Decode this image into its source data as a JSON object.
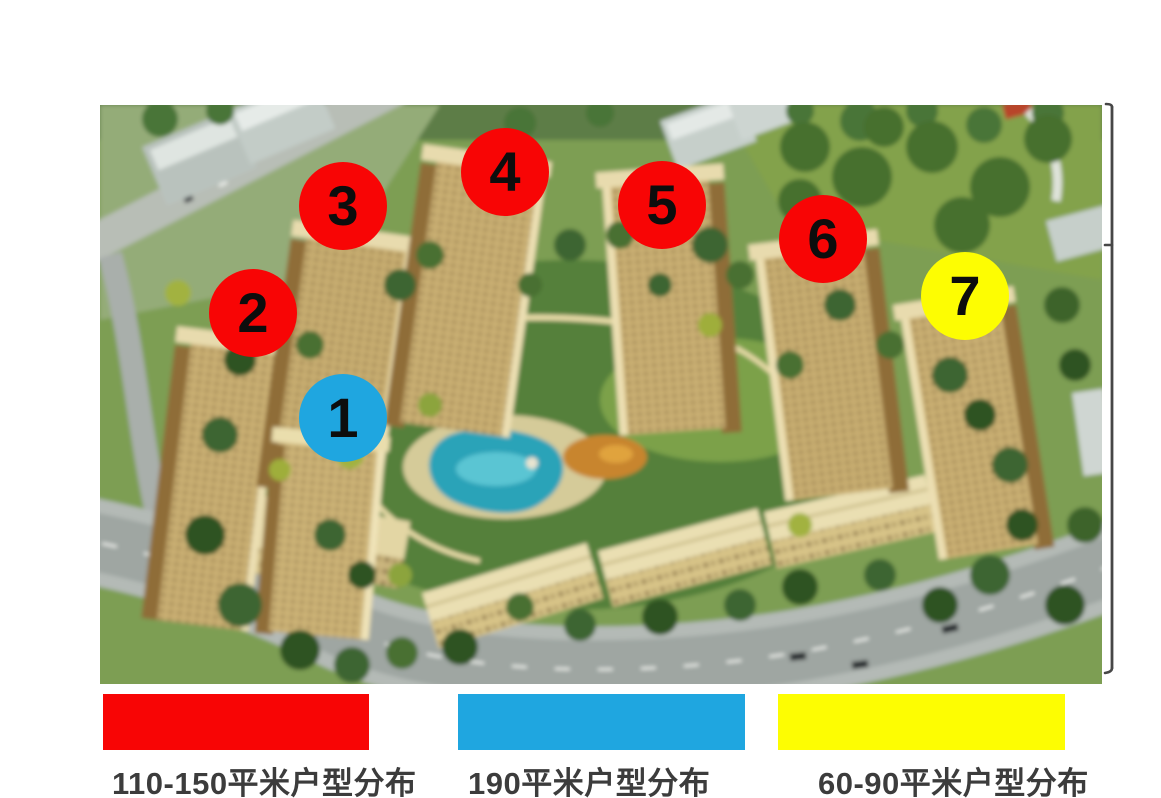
{
  "colors": {
    "red": "#f80505",
    "blue": "#1fa6e0",
    "yellow": "#fdfd02"
  },
  "site_plan": {
    "markers": [
      {
        "number": "1",
        "color": "blue",
        "x": 243,
        "y": 313
      },
      {
        "number": "2",
        "color": "red",
        "x": 153,
        "y": 208
      },
      {
        "number": "3",
        "color": "red",
        "x": 243,
        "y": 101
      },
      {
        "number": "4",
        "color": "red",
        "x": 405,
        "y": 67
      },
      {
        "number": "5",
        "color": "red",
        "x": 562,
        "y": 100
      },
      {
        "number": "6",
        "color": "red",
        "x": 723,
        "y": 134
      },
      {
        "number": "7",
        "color": "yellow",
        "x": 865,
        "y": 191
      }
    ]
  },
  "legend": {
    "items": [
      {
        "label": "110-150平米户型分布",
        "color": "red"
      },
      {
        "label": "190平米户型分布",
        "color": "blue"
      },
      {
        "label": "60-90平米户型分布",
        "color": "yellow"
      }
    ]
  }
}
